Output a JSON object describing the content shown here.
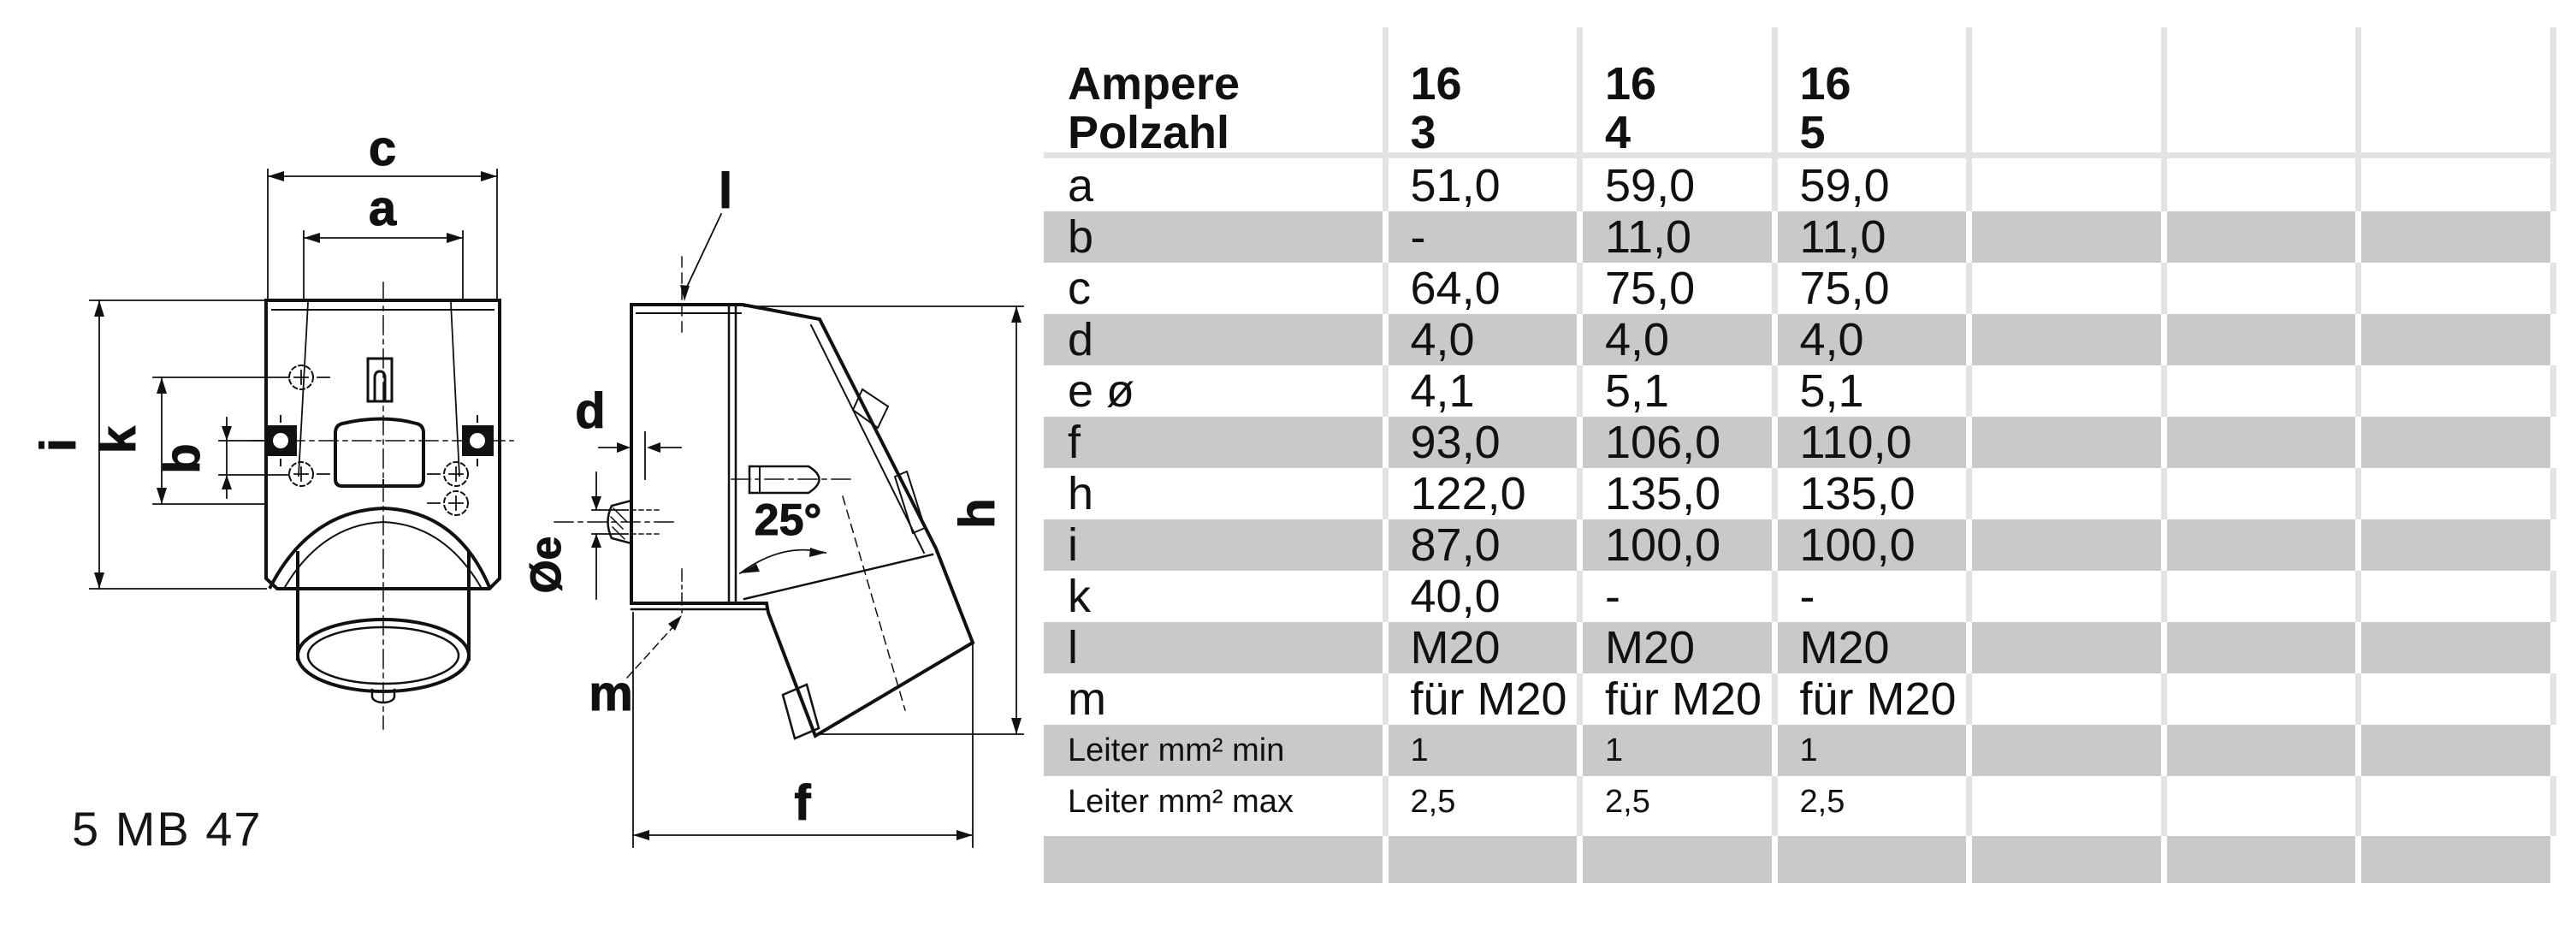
{
  "part_number": "5 MB 47",
  "table": {
    "header": {
      "row1_label": "Ampere",
      "row2_label": "Polzahl",
      "columns": [
        {
          "ampere": "16",
          "polzahl": "3"
        },
        {
          "ampere": "16",
          "polzahl": "4"
        },
        {
          "ampere": "16",
          "polzahl": "5"
        },
        {
          "ampere": "",
          "polzahl": ""
        },
        {
          "ampere": "",
          "polzahl": ""
        },
        {
          "ampere": "",
          "polzahl": ""
        }
      ]
    },
    "rows": [
      {
        "label": "a",
        "shade": "white",
        "small": false,
        "values": [
          "51,0",
          "59,0",
          "59,0",
          "",
          "",
          ""
        ]
      },
      {
        "label": "b",
        "shade": "gray",
        "small": false,
        "values": [
          "-",
          "11,0",
          "11,0",
          "",
          "",
          ""
        ]
      },
      {
        "label": "c",
        "shade": "white",
        "small": false,
        "values": [
          "64,0",
          "75,0",
          "75,0",
          "",
          "",
          ""
        ]
      },
      {
        "label": "d",
        "shade": "gray",
        "small": false,
        "values": [
          "4,0",
          "4,0",
          "4,0",
          "",
          "",
          ""
        ]
      },
      {
        "label": "e ø",
        "shade": "white",
        "small": false,
        "values": [
          "4,1",
          "5,1",
          "5,1",
          "",
          "",
          ""
        ]
      },
      {
        "label": "f",
        "shade": "gray",
        "small": false,
        "values": [
          "93,0",
          "106,0",
          "110,0",
          "",
          "",
          ""
        ]
      },
      {
        "label": "h",
        "shade": "white",
        "small": false,
        "values": [
          "122,0",
          "135,0",
          "135,0",
          "",
          "",
          ""
        ]
      },
      {
        "label": "i",
        "shade": "gray",
        "small": false,
        "values": [
          "87,0",
          "100,0",
          "100,0",
          "",
          "",
          ""
        ]
      },
      {
        "label": "k",
        "shade": "white",
        "small": false,
        "values": [
          "40,0",
          "-",
          "-",
          "",
          "",
          ""
        ]
      },
      {
        "label": "l",
        "shade": "gray",
        "small": false,
        "values": [
          "M20",
          "M20",
          "M20",
          "",
          "",
          ""
        ]
      },
      {
        "label": "m",
        "shade": "white",
        "small": false,
        "values": [
          "für M20",
          "für M20",
          "für M20",
          "",
          "",
          ""
        ]
      },
      {
        "label": "Leiter mm² min",
        "shade": "gray",
        "small": true,
        "values": [
          "1",
          "1",
          "1",
          "",
          "",
          ""
        ]
      },
      {
        "label": "Leiter mm² max",
        "shade": "white",
        "small": true,
        "values": [
          "2,5",
          "2,5",
          "2,5",
          "",
          "",
          ""
        ]
      }
    ],
    "empty_footer_row": {
      "shade": "gray",
      "values": [
        "",
        "",
        "",
        "",
        "",
        "",
        ""
      ]
    }
  },
  "drawing": {
    "front_view_labels": {
      "c": "c",
      "a": "a",
      "i": "i",
      "k": "k",
      "b": "b"
    },
    "side_view_labels": {
      "l": "l",
      "d": "d",
      "diameter_e": "Øe",
      "angle": "25°",
      "m": "m",
      "h": "h",
      "f": "f"
    }
  },
  "colors": {
    "row_gray": "#c9c9c9",
    "grid_light": "#e3e3e3",
    "line": "#111111",
    "text": "#111111"
  }
}
